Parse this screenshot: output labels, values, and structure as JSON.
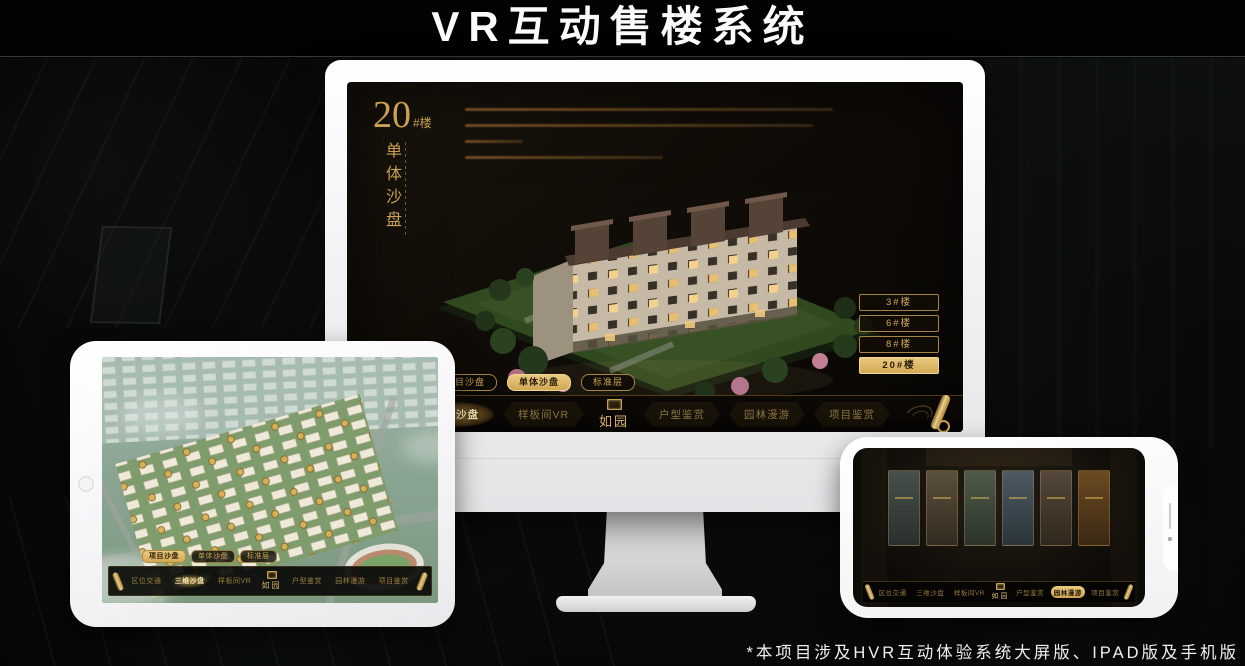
{
  "page": {
    "title": "VR互动售楼系统",
    "footnote": "*本项目涉及HVR互动体验系统大屏版、IPAD版及手机版"
  },
  "colors": {
    "gold": "#c9a254",
    "gold_bright": "#e9cd87",
    "screen_bg": "#120e08",
    "frame_white": "#f4f4f6"
  },
  "icons": {
    "nav_end": "scroll-icon",
    "brand_seal": "seal-icon",
    "tablet_home": "home-button",
    "phone_speaker": "speaker-slit",
    "phone_camera": "camera-icon"
  },
  "brand": {
    "logo": "如园"
  },
  "monitor": {
    "unit_number": "20",
    "unit_suffix": "#楼",
    "unit_subtitle": "单体沙盘",
    "floor_buttons": [
      {
        "label": "3#楼"
      },
      {
        "label": "6#楼"
      },
      {
        "label": "8#楼"
      },
      {
        "label": "20#楼",
        "active": true
      }
    ],
    "view_tabs": [
      {
        "label": "项目沙盘"
      },
      {
        "label": "单体沙盘",
        "active": true
      },
      {
        "label": "标准层"
      }
    ],
    "nav_items": [
      {
        "label": "区位交通"
      },
      {
        "label": "三维沙盘",
        "active": true
      },
      {
        "label": "样板间VR"
      },
      {
        "label": "户型鉴赏"
      },
      {
        "label": "园林漫游"
      },
      {
        "label": "项目鉴赏"
      }
    ]
  },
  "tablet": {
    "view_tabs": [
      {
        "label": "项目沙盘",
        "active": true
      },
      {
        "label": "单体沙盘"
      },
      {
        "label": "标准层"
      }
    ],
    "nav_items": [
      {
        "label": "区位交通"
      },
      {
        "label": "三维沙盘",
        "active": true
      },
      {
        "label": "样板间VR"
      },
      {
        "label": "户型鉴赏"
      },
      {
        "label": "园林漫游"
      },
      {
        "label": "项目鉴赏"
      }
    ]
  },
  "phone": {
    "nav_items": [
      {
        "label": "区位交通"
      },
      {
        "label": "三维沙盘"
      },
      {
        "label": "样板间VR"
      },
      {
        "label": "户型鉴赏"
      },
      {
        "label": "园林漫游",
        "active": true
      },
      {
        "label": "项目鉴赏"
      }
    ]
  }
}
